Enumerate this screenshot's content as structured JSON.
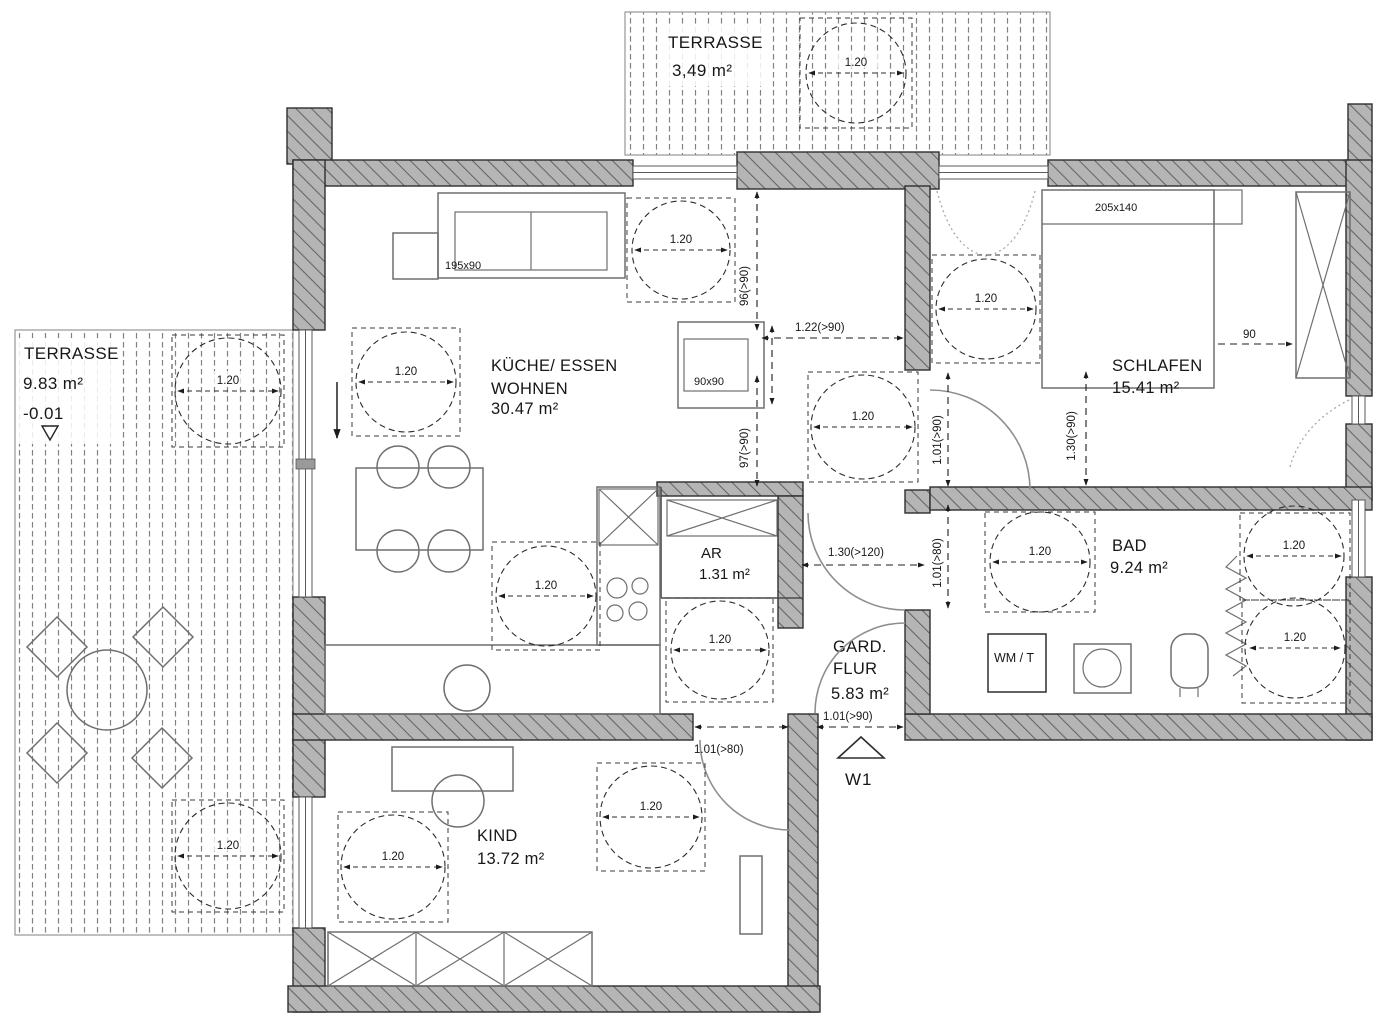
{
  "rooms": {
    "terrasse_top": {
      "name": "TERRASSE",
      "area": "3,49 m²"
    },
    "terrasse_left": {
      "name": "TERRASSE",
      "area": "9.83 m²",
      "level": "-0.01"
    },
    "kueche": {
      "name1": "KÜCHE/ ESSEN",
      "name2": "WOHNEN",
      "area": "30.47 m²"
    },
    "schlafen": {
      "name": "SCHLAFEN",
      "area": "15.41 m²"
    },
    "bad": {
      "name": "BAD",
      "area": "9.24 m²"
    },
    "ar": {
      "name": "AR",
      "area": "1.31 m²"
    },
    "flur": {
      "name1": "GARD.",
      "name2": "FLUR",
      "area": "5.83 m²"
    },
    "kind": {
      "name": "KIND",
      "area": "13.72 m²"
    }
  },
  "furniture": {
    "sofa_size": "195x90",
    "bed_size": "205x140",
    "table_size": "90x90",
    "washer": "WM / T"
  },
  "dims": {
    "r120": "1.20",
    "d122": "1.22(>90)",
    "d96": "96(>90)",
    "d97": "97(>90)",
    "d101_90": "1.01(>90)",
    "d101_80": "1.01(>80)",
    "d130_90": "1.30(>90)",
    "d130_120": "1.30(>120)",
    "d90": "90"
  },
  "markers": {
    "entrance": "W1"
  },
  "colors": {
    "wall_fill": "#b5b5b5",
    "wall_hatch": "#646464",
    "line": "#2e2e2e",
    "furniture": "#707070",
    "dim_text": "#171717"
  }
}
